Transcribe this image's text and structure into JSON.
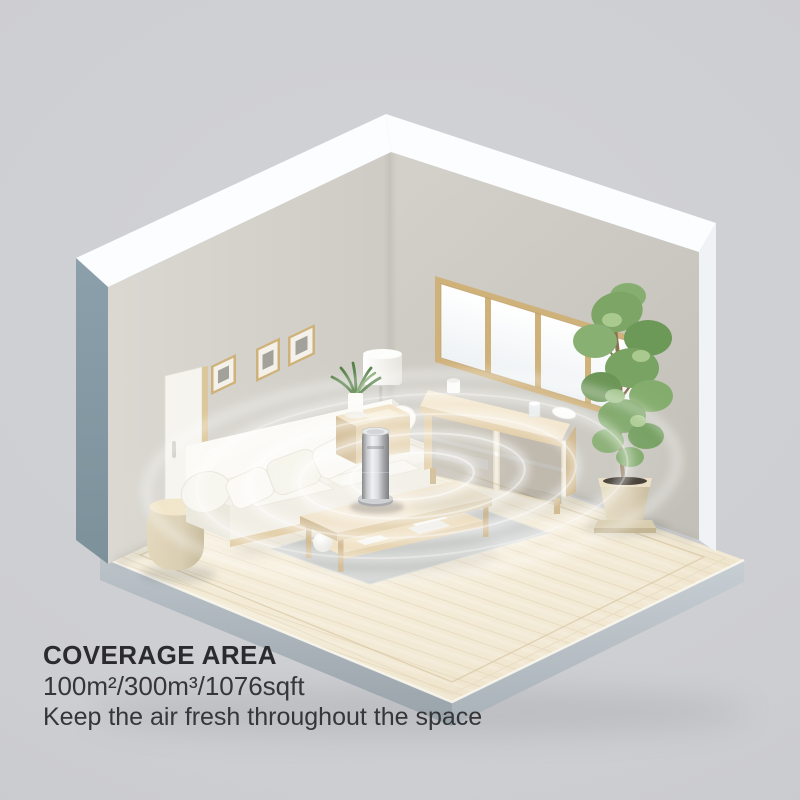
{
  "caption": {
    "title": "COVERAGE AREA",
    "specs": "100m²/300m³/1076sqft",
    "tagline": "Keep the air fresh throughout the space"
  },
  "scene": {
    "objects": [
      "living room corner",
      "left wall picture frames",
      "window",
      "panel floor lamp",
      "drum floor lamp",
      "white sofa with pillows",
      "wooden side table",
      "small potted plant",
      "coffee table with shelf",
      "gray rug",
      "wooden sideboard with glass doors",
      "potted tree",
      "tower air purifier",
      "coverage ripple rings"
    ]
  },
  "colors": {
    "background": "#d2d3d7",
    "caption_title": "#2b2b2d",
    "caption_text": "#363638",
    "wall_left": "#dad8d1",
    "wall_right": "#d2d0c8",
    "wall_edge_top": "#fbfdfe",
    "wall_end_left": "#8ba0ab",
    "wall_end_right": "#eff3f5",
    "slab_side": "#a9b3ba",
    "floor_wood": "#f2e9d4",
    "floor_plank": "#dccbaa",
    "wood_light": "#eedcba",
    "wood_mid": "#e0caa0",
    "wood_dark": "#cbb183",
    "window_frame": "#cfb17a",
    "sofa_cream": "#f0ede2",
    "cushion_white": "#fbfaf5",
    "rug": "#c9cccb",
    "glass": "#7d766a",
    "plant_green": "#79a463",
    "plant_green_dark": "#557f46",
    "pot": "#d9cdb2",
    "purifier_light": "#f0f1f3",
    "purifier_dark": "#85878a",
    "ripple": "#ffffff"
  }
}
